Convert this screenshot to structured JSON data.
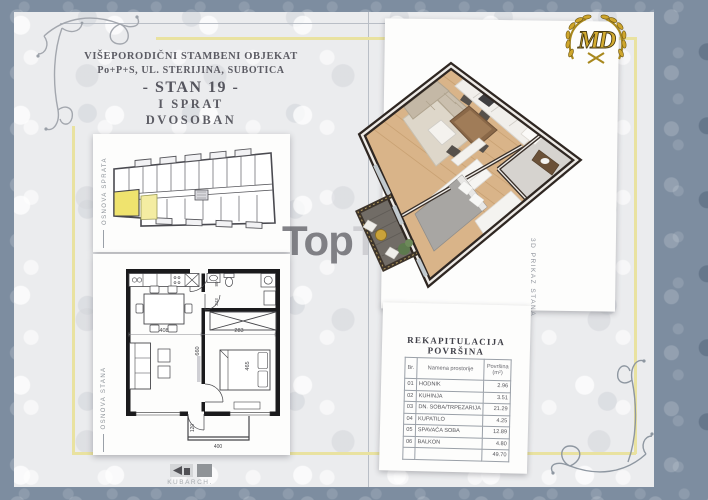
{
  "header": {
    "building": "VIŠEPORODIČNI STAMBENI OBJEKAT",
    "address": "Po+P+S, UL. STERIJINA, SUBOTICA",
    "unit": "- STAN 19 -",
    "floor": "I SPRAT",
    "type": "DVOSOBAN"
  },
  "side_labels": {
    "floor_sketch": "OSNOVA SPRATA",
    "unit_plan": "OSNOVA STANA",
    "view_3d": "3D PRIKAZ STANA"
  },
  "logo": {
    "monogram": "MD"
  },
  "watermark": {
    "part1": "Top",
    "part2": "Tip"
  },
  "brand": {
    "name": "KUBARCH."
  },
  "plan_dimensions": {
    "living_width": "408",
    "bedroom_width": "283",
    "apartment_depth": "660",
    "bedroom_depth": "465",
    "bathroom_depth": "243",
    "bathroom_width": "80",
    "balcony_depth": "120",
    "balcony_width": "400"
  },
  "area_table": {
    "title": "REKAPITULACIJA POVRŠINA",
    "columns": {
      "num": "Br.",
      "name": "Namena prostorije",
      "area1": "Površina",
      "area2": "(m²)"
    },
    "rows": [
      {
        "num": "01",
        "name": "HODNIK",
        "area": "2.96"
      },
      {
        "num": "02",
        "name": "KUHINJA",
        "area": "3.51"
      },
      {
        "num": "03",
        "name": "DN. SOBA/TRPEZARIJA",
        "area": "21.29"
      },
      {
        "num": "04",
        "name": "KUPATILO",
        "area": "4.25"
      },
      {
        "num": "05",
        "name": "SPAVAĆA SOBA",
        "area": "12.89"
      },
      {
        "num": "06",
        "name": "BALKON",
        "area": "4.80"
      }
    ],
    "total": "49.70"
  },
  "colors": {
    "frame_gold": "#e9e2a0",
    "highlight_yellow": "#efe36e",
    "border_damask": "#7d8da0",
    "logo_gold": "#c9a42d"
  }
}
